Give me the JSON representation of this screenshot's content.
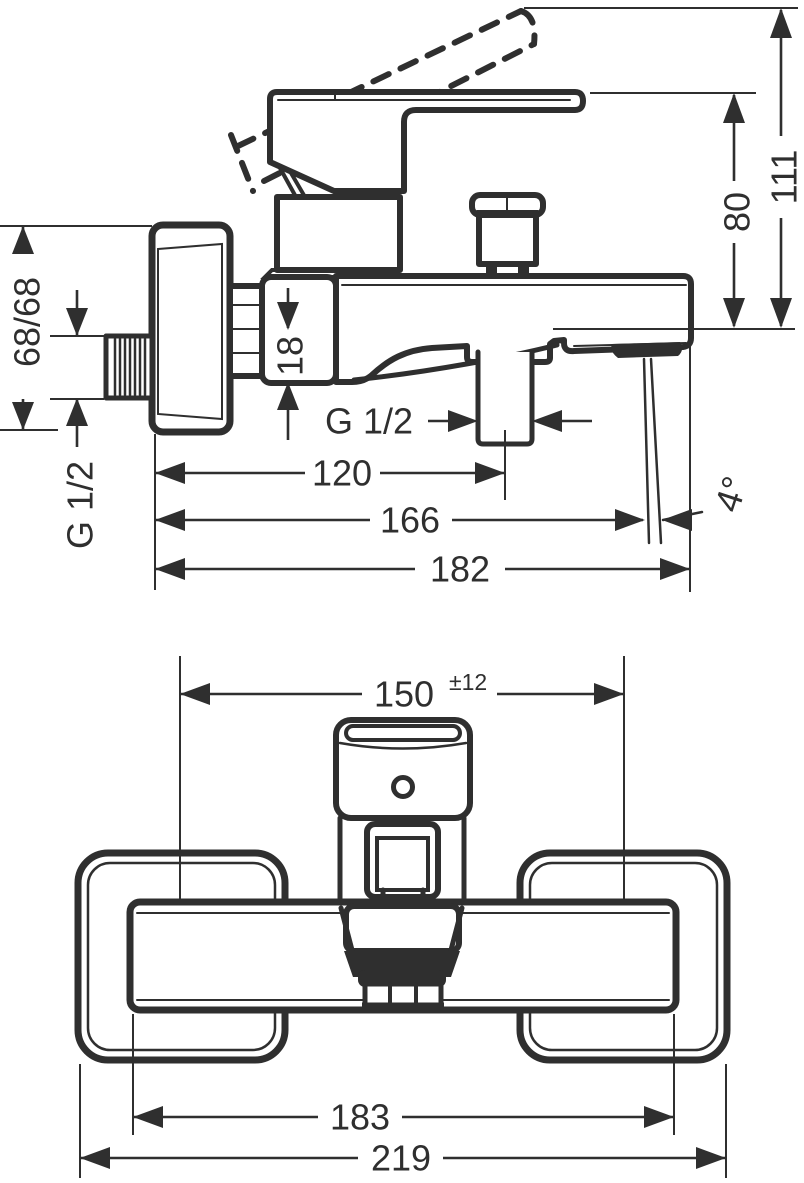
{
  "drawing": {
    "title": "bath-mixer-technical-drawing",
    "side_view": {
      "dims": {
        "height_total": "111",
        "height_handle": "80",
        "plate_size": "68/68",
        "inlet_thread": "G 1/2",
        "spout_drop": "18",
        "outlet_thread": "G 1/2",
        "depth_outlet": "120",
        "depth_stream": "166",
        "depth_total": "182",
        "stream_angle": "4°"
      }
    },
    "front_view": {
      "dims": {
        "connection_centers": "150",
        "connection_tolerance": "±12",
        "body_width": "183",
        "overall_width": "219"
      }
    },
    "line_color": "#2f2f2f",
    "background_color": "#ffffff"
  }
}
